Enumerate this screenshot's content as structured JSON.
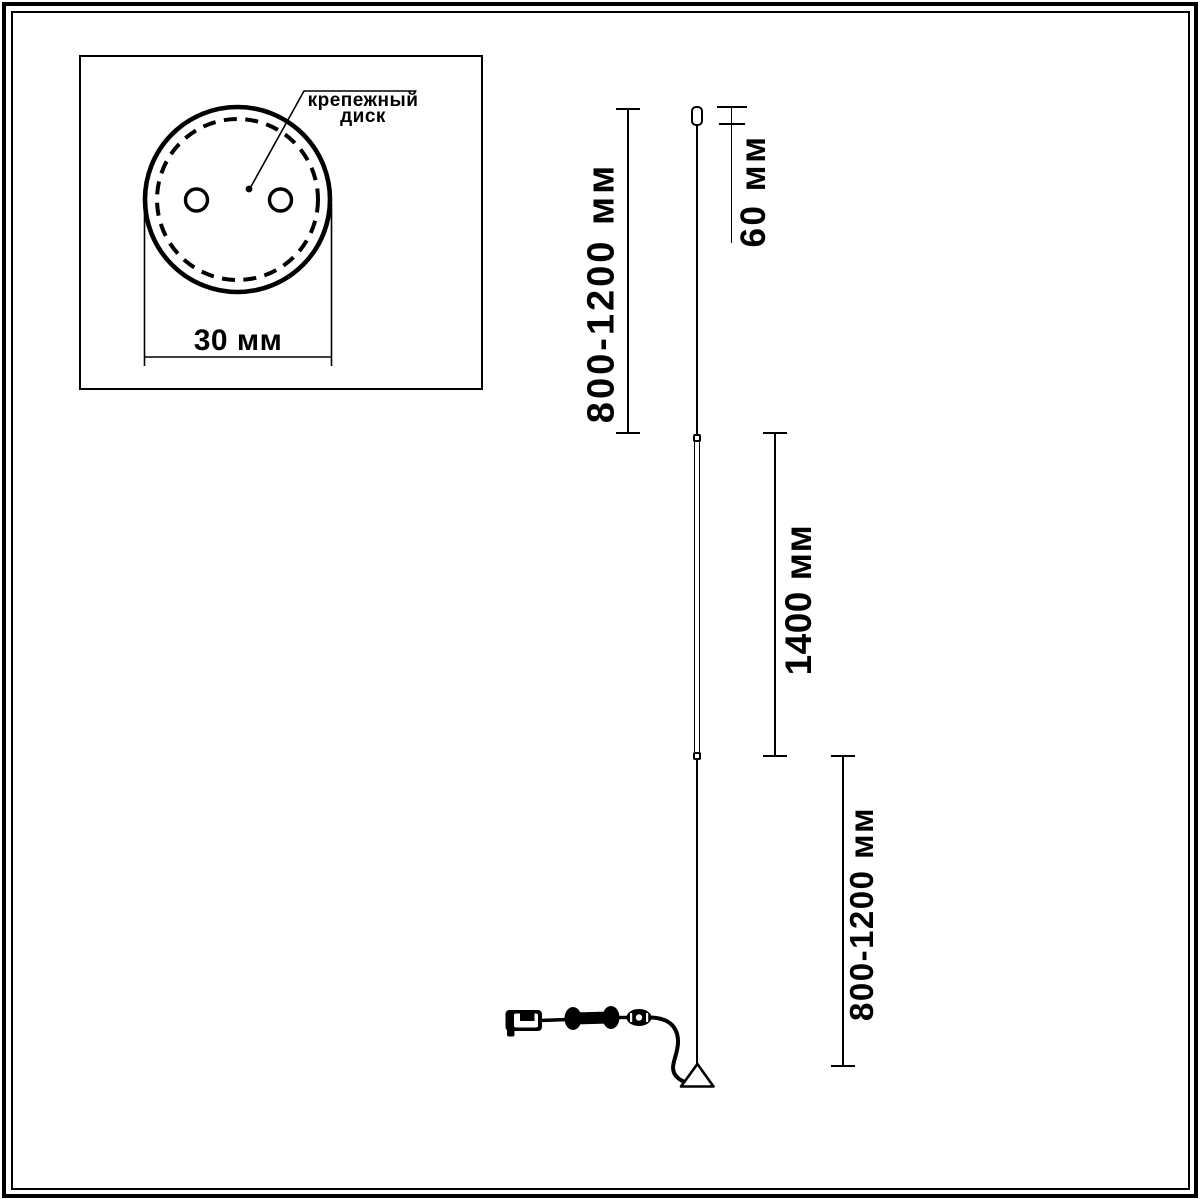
{
  "inset": {
    "label_line1": "крепежный",
    "label_line2": "диск",
    "diameter_label": "30 мм"
  },
  "dimensions": {
    "upper_cable_label": "800-1200 мм",
    "mount_label": "60 мм",
    "tube_label": "1400 мм",
    "lower_cable_label": "800-1200 мм"
  },
  "colors": {
    "ink": "#000000",
    "paper": "#ffffff"
  }
}
